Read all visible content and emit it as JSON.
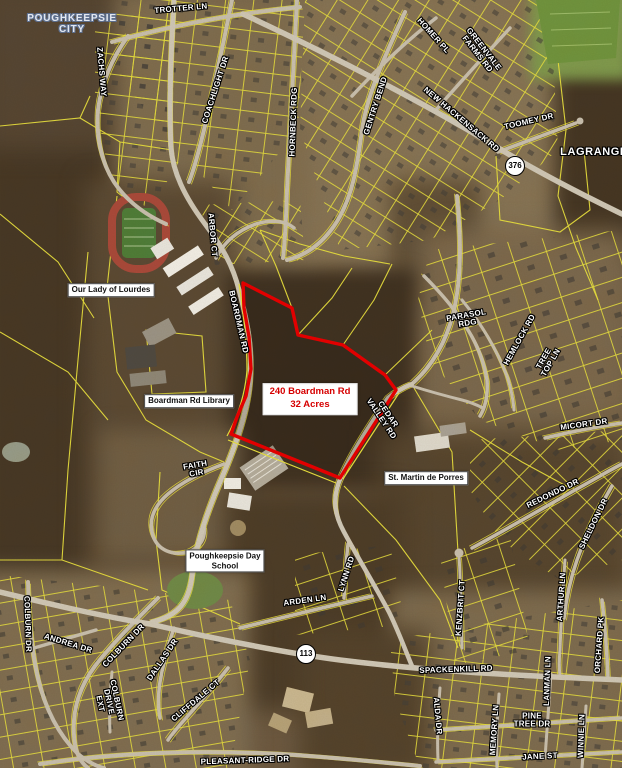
{
  "map_title": "240 Boardman Rd 32 Acres",
  "parcel_label": {
    "line1": "240 Boardman Rd",
    "line2": "32 Acres"
  },
  "colors": {
    "boundary_red": "#e80000",
    "parcel_line_yellow": "#e8e040",
    "road_gray": "#c8c0b2",
    "road_label_text": "#ffffff",
    "city_label_text": "#e3e8f1",
    "box_label_text": "#111111",
    "red_label_text": "#d60000",
    "field_green": "#6f9440"
  },
  "shields": [
    {
      "id": "route-376",
      "text": "376",
      "x": 515,
      "y": 166
    },
    {
      "id": "route-113",
      "text": "113",
      "x": 306,
      "y": 654
    }
  ],
  "labels": [
    {
      "id": "poughkeepsie-city",
      "lines": [
        "POUGHKEEPSIE",
        "CITY"
      ],
      "x": 72,
      "y": 24,
      "rot": 0,
      "type": "city"
    },
    {
      "id": "trotter-ln",
      "lines": [
        "TROTTER LN"
      ],
      "x": 181,
      "y": 9,
      "rot": -5,
      "type": "road"
    },
    {
      "id": "zachs-way",
      "lines": [
        "ZACHS WAY"
      ],
      "x": 101,
      "y": 72,
      "rot": 85,
      "type": "road"
    },
    {
      "id": "coachlight-dr",
      "lines": [
        "COACHLIGHT DR"
      ],
      "x": 216,
      "y": 90,
      "rot": -72,
      "type": "road"
    },
    {
      "id": "hornbeck-rdg",
      "lines": [
        "HORNBECK RDG"
      ],
      "x": 294,
      "y": 122,
      "rot": -88,
      "type": "road"
    },
    {
      "id": "homer-pl",
      "lines": [
        "HOMER PL"
      ],
      "x": 433,
      "y": 36,
      "rot": 48,
      "type": "road"
    },
    {
      "id": "greenvale-farms-rd",
      "lines": [
        "GREENVALE",
        "FARMS RD"
      ],
      "x": 480,
      "y": 52,
      "rot": 52,
      "type": "road"
    },
    {
      "id": "gentry-bend",
      "lines": [
        "GENTRY BEND"
      ],
      "x": 376,
      "y": 106,
      "rot": -72,
      "type": "road"
    },
    {
      "id": "new-hackensack-rd",
      "lines": [
        "NEW HACKENSACK RD"
      ],
      "x": 461,
      "y": 120,
      "rot": 40,
      "type": "road"
    },
    {
      "id": "toomey-dr",
      "lines": [
        "TOOMEY DR"
      ],
      "x": 529,
      "y": 122,
      "rot": -13,
      "type": "road"
    },
    {
      "id": "lagrange",
      "lines": [
        "LAGRANGE"
      ],
      "x": 594,
      "y": 153,
      "rot": 0,
      "type": "place"
    },
    {
      "id": "arbor-ct",
      "lines": [
        "ARBOR CT"
      ],
      "x": 212,
      "y": 235,
      "rot": 85,
      "type": "road"
    },
    {
      "id": "boardman-rd",
      "lines": [
        "BOARDMAN RD"
      ],
      "x": 238,
      "y": 322,
      "rot": 77,
      "type": "road"
    },
    {
      "id": "parasol-rdg",
      "lines": [
        "PARASOL",
        "RDG"
      ],
      "x": 467,
      "y": 320,
      "rot": -10,
      "type": "road"
    },
    {
      "id": "hemlock-rd",
      "lines": [
        "HEMLOCK RD"
      ],
      "x": 520,
      "y": 340,
      "rot": -61,
      "type": "road"
    },
    {
      "id": "tree-top-ln",
      "lines": [
        "TREE",
        "TOP LN"
      ],
      "x": 548,
      "y": 361,
      "rot": -60,
      "type": "road"
    },
    {
      "id": "micort-dr",
      "lines": [
        "MICORT DR"
      ],
      "x": 584,
      "y": 425,
      "rot": -8,
      "type": "road"
    },
    {
      "id": "cedar-valley-rd",
      "lines": [
        "CEDAR",
        "VALLEY RD"
      ],
      "x": 384,
      "y": 417,
      "rot": 56,
      "type": "road"
    },
    {
      "id": "redondo-dr",
      "lines": [
        "REDONDO DR"
      ],
      "x": 553,
      "y": 494,
      "rot": -26,
      "type": "road"
    },
    {
      "id": "sheldon-dr",
      "lines": [
        "SHELDON DR"
      ],
      "x": 594,
      "y": 524,
      "rot": -64,
      "type": "road"
    },
    {
      "id": "arthur-ln",
      "lines": [
        "ARTHUR LN"
      ],
      "x": 562,
      "y": 597,
      "rot": -86,
      "type": "road"
    },
    {
      "id": "kenzbrit-ct",
      "lines": [
        "KENZBRIT CT"
      ],
      "x": 461,
      "y": 608,
      "rot": -86,
      "type": "road"
    },
    {
      "id": "faith-cir",
      "lines": [
        "FAITH",
        "CIR"
      ],
      "x": 196,
      "y": 470,
      "rot": -10,
      "type": "road"
    },
    {
      "id": "lynn-rd",
      "lines": [
        "LYNN RD"
      ],
      "x": 347,
      "y": 574,
      "rot": -72,
      "type": "road"
    },
    {
      "id": "arden-ln",
      "lines": [
        "ARDEN LN"
      ],
      "x": 305,
      "y": 601,
      "rot": -8,
      "type": "road"
    },
    {
      "id": "colburn-dr-west",
      "lines": [
        "COLBURN DR"
      ],
      "x": 27,
      "y": 624,
      "rot": 88,
      "type": "road"
    },
    {
      "id": "andrea-dr",
      "lines": [
        "ANDREA DR"
      ],
      "x": 68,
      "y": 644,
      "rot": 17,
      "type": "road"
    },
    {
      "id": "colburn-dr",
      "lines": [
        "COLBURN DR"
      ],
      "x": 124,
      "y": 646,
      "rot": -46,
      "type": "road"
    },
    {
      "id": "dallas-dr",
      "lines": [
        "DALLAS DR"
      ],
      "x": 163,
      "y": 660,
      "rot": -56,
      "type": "road"
    },
    {
      "id": "colburn-drive-ext",
      "lines": [
        "COLBURN",
        "DRIVE",
        "EXT"
      ],
      "x": 108,
      "y": 702,
      "rot": 78,
      "type": "road"
    },
    {
      "id": "cliffdale-ct",
      "lines": [
        "CLIFFDALE CT"
      ],
      "x": 196,
      "y": 701,
      "rot": -40,
      "type": "road"
    },
    {
      "id": "spackenkill-rd",
      "lines": [
        "SPACKENKILL RD"
      ],
      "x": 456,
      "y": 670,
      "rot": -2,
      "type": "road"
    },
    {
      "id": "alda-dr",
      "lines": [
        "ALDA DR"
      ],
      "x": 437,
      "y": 716,
      "rot": 85,
      "type": "road"
    },
    {
      "id": "orchard-pk",
      "lines": [
        "ORCHARD PK"
      ],
      "x": 600,
      "y": 645,
      "rot": -86,
      "type": "road"
    },
    {
      "id": "memory-ln",
      "lines": [
        "MEMORY LN"
      ],
      "x": 495,
      "y": 730,
      "rot": -86,
      "type": "road"
    },
    {
      "id": "lanman-ln",
      "lines": [
        "LANMAN LN"
      ],
      "x": 548,
      "y": 681,
      "rot": -88,
      "type": "road"
    },
    {
      "id": "pine-tree-dr",
      "lines": [
        "PINE",
        "TREE DR"
      ],
      "x": 532,
      "y": 721,
      "rot": 0,
      "type": "road"
    },
    {
      "id": "jane-st",
      "lines": [
        "JANE ST"
      ],
      "x": 540,
      "y": 757,
      "rot": -3,
      "type": "road"
    },
    {
      "id": "winnie-ln",
      "lines": [
        "WINNIE LN"
      ],
      "x": 582,
      "y": 736,
      "rot": -88,
      "type": "road"
    },
    {
      "id": "pleasant-ridge-dr",
      "lines": [
        "PLEASANT-RIDGE DR"
      ],
      "x": 245,
      "y": 761,
      "rot": -2,
      "type": "road"
    },
    {
      "id": "our-lady-of-lourdes",
      "lines": [
        "Our Lady of Lourdes"
      ],
      "x": 111,
      "y": 290,
      "rot": 0,
      "type": "box"
    },
    {
      "id": "boardman-rd-library",
      "lines": [
        "Boardman Rd Library"
      ],
      "x": 189,
      "y": 401,
      "rot": 0,
      "type": "box"
    },
    {
      "id": "st-martin-de-porres",
      "lines": [
        "St. Martin de Porres"
      ],
      "x": 426,
      "y": 478,
      "rot": 0,
      "type": "box"
    },
    {
      "id": "poughkeepsie-day-school",
      "lines": [
        "Poughkeepsie Day",
        "School"
      ],
      "x": 225,
      "y": 561,
      "rot": 0,
      "type": "box"
    },
    {
      "id": "parcel-240-boardman",
      "lines": [
        "240 Boardman Rd",
        "32 Acres"
      ],
      "x": 310,
      "y": 399,
      "rot": 0,
      "type": "redbox"
    }
  ]
}
